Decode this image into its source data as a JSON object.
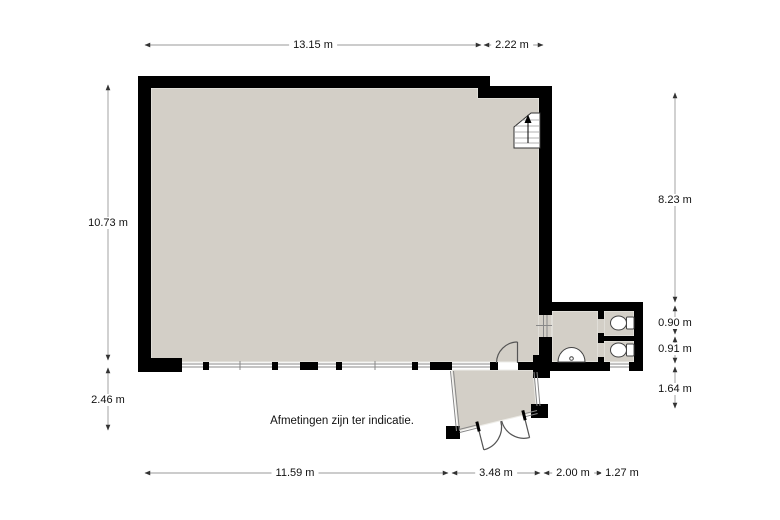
{
  "note": "Afmetingen zijn ter indicatie.",
  "dimensions": {
    "top": [
      "13.15 m",
      "2.22 m"
    ],
    "left": [
      "10.73 m",
      "2.46 m"
    ],
    "right": [
      "8.23 m",
      "0.90 m",
      "0.91 m",
      "1.64 m"
    ],
    "bottom": [
      "11.59 m",
      "3.48 m",
      "2.00 m",
      "1.27 m"
    ]
  },
  "fixtures": [
    "staircase-up-icon",
    "toilet-icon",
    "toilet-icon",
    "sink-icon",
    "double-entry-door-icon",
    "interior-door-icon"
  ],
  "colors": {
    "wall": "#000000",
    "floor": "#d3cfc7",
    "background": "#ffffff",
    "dimension_line": "#999999",
    "arrow": "#333333",
    "text": "#111111"
  }
}
